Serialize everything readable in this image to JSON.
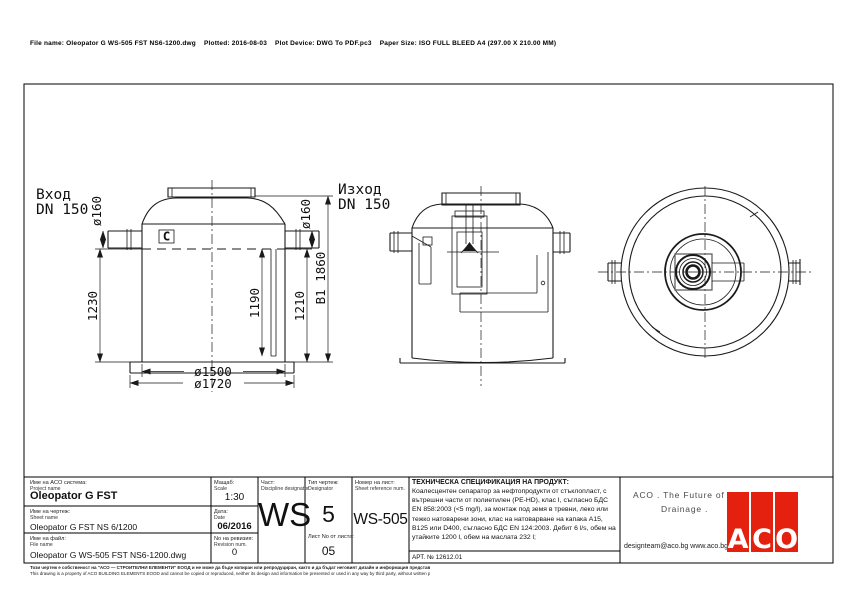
{
  "header": {
    "file_info": "File name: Oleopator G WS-505 FST NS6-1200.dwg    Plotted: 2016-08-03    Plot Device: DWG To PDF.pc3    Paper Size: ISO FULL BLEED A4 (297.00 X 210.00 MM)"
  },
  "drawing": {
    "inlet_label": "Вход",
    "inlet_dn": "DN 150",
    "outlet_label": "Изход",
    "outlet_dn": "DN 150",
    "dims": {
      "inlet_dia": "ø160",
      "outlet_dia": "ø160",
      "height_left": "1230",
      "height_inner": "1190",
      "height_right": "1210",
      "overall_height": "B1 1860",
      "tank_dia": "ø1500",
      "base_dia": "ø1720"
    },
    "baffle_icon_glyph": "C"
  },
  "title_block": {
    "project": {
      "label_bg": "Име на ACO система:",
      "label_en": "Project name",
      "value": "Oleopator G FST"
    },
    "sheet": {
      "label_bg": "Име на чертеж:",
      "label_en": "Sheet name",
      "value": "Oleopator G FST NS 6/1200"
    },
    "file": {
      "label_bg": "Име на файл:",
      "label_en": "File name",
      "value": "Oleopator G WS-505 FST NS6-1200.dwg"
    },
    "scale": {
      "label_bg": "Мащаб:",
      "label_en": "Scale",
      "value": "1:30"
    },
    "date": {
      "label_bg": "Дата:",
      "label_en": "Date",
      "value": "06/2016"
    },
    "revision": {
      "label_bg": "No на ревизия:",
      "label_en": "Revision num.",
      "value": "0"
    },
    "discipline": {
      "label_bg": "Част:",
      "label_en": "Discipline designator",
      "value": "WS"
    },
    "type": {
      "label_bg": "Тип чертеж:",
      "label_en": "Designator",
      "value": "5"
    },
    "sheet_no": {
      "label_bg": "Лист No от листа:",
      "value": "05"
    },
    "sheet_ref": {
      "label_bg": "Номер на лист:",
      "label_en": "Sheet reference num.",
      "value": "WS-505"
    },
    "spec": {
      "title": "ТЕХНИЧЕСКА СПЕЦИФИКАЦИЯ НА ПРОДУКТ:",
      "body": "Коалесцентен сепаратор за нефтопродукти от стъклопласт, с вътрешни части от полиетилен (PE-HD), клас I, съгласно БДС EN 858:2003 (<5 mg/l), за монтаж под земя в тревни, леко или тежко натоварени зони, клас на натоварване на капака A15, B125 или D400, съгласно БДС EN 124:2003. Дебит 6 l/s, обем на утайките 1200 l, обем на маслата 232 l;",
      "art": "АРТ. № 12612.01"
    },
    "aco": {
      "slogan_1": "ACO . The Future of",
      "slogan_2": "Drainage .",
      "contact": "designteam@aco.bg  www.aco.bg",
      "logo_letters": [
        "A",
        "C",
        "O"
      ],
      "logo_color": "#e4200e"
    }
  },
  "footer": {
    "disclaimer_bg": "Този чертеж е собственост на \"АСО — СТРОИТЕЛНИ ЕЛЕМЕНТИ\" ЕООД и не може да бъде копиран или репродуциран, както и да бъдат неговият дизайн и информация представяни или използвани по какъвто и да е начин от трети страни, без писмено разрешение.",
    "disclaimer_en": "This drawing is a property of ACO BUILDING ELEMENTS EOOD and cannot be copied or reproduced, neither its design and information be presented or used in any way by third party, without written permission."
  }
}
